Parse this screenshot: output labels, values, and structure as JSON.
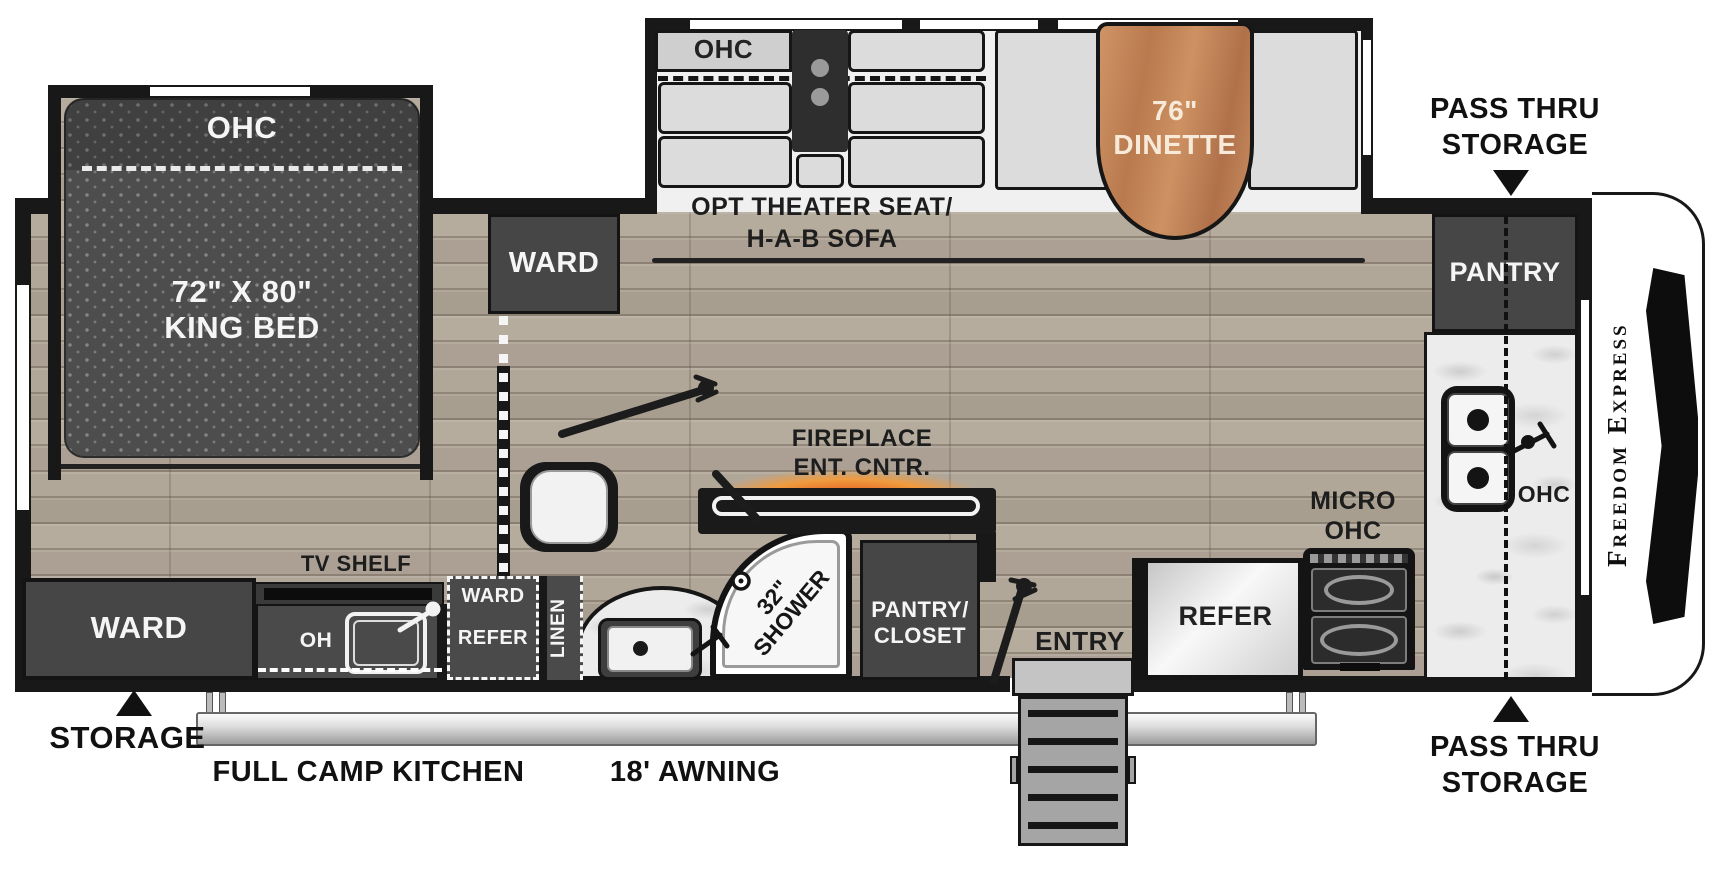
{
  "floorplan": {
    "brand": "Freedom Express",
    "bedroom": {
      "ohc": "OHC",
      "bed_size": "72\" X 80\"",
      "bed_type": "KING BED",
      "ward": "WARD"
    },
    "living": {
      "ohc": "OHC",
      "opt_line1": "OPT THEATER SEAT/",
      "opt_line2": "H-A-B SOFA",
      "dinette_size": "76\"",
      "dinette_name": "DINETTE"
    },
    "kitchen": {
      "pantry": "PANTRY",
      "micro_line1": "MICRO",
      "micro_line2": "OHC",
      "counter_ohc": "OHC",
      "refer": "REFER"
    },
    "bathroom": {
      "shower_size": "32\"",
      "shower_label": "SHOWER",
      "linen": "LINEN"
    },
    "midship": {
      "fireplace_line1": "FIREPLACE",
      "fireplace_line2": "ENT. CNTR.",
      "pantry_closet_line1": "PANTRY/",
      "pantry_closet_line2": "CLOSET",
      "entry": "ENTRY"
    },
    "rear": {
      "ward": "WARD",
      "tv_shelf": "TV SHELF",
      "oh": "OH",
      "ward_refer_line1": "WARD",
      "ward_refer_line2": "REFER",
      "storage": "STORAGE"
    },
    "exterior": {
      "pass_thru_line1": "PASS THRU",
      "pass_thru_line2": "STORAGE",
      "camp_kitchen": "FULL CAMP KITCHEN",
      "awning": "18' AWNING"
    },
    "colors": {
      "wall": "#181818",
      "cabinet_dark": "#464646",
      "wood_floor": "#b2a89a",
      "dinette_wood": "#c18255",
      "fireplace_glow": "#e8622a",
      "marble": "#ececec",
      "mattress": "#4d4d4d"
    }
  }
}
